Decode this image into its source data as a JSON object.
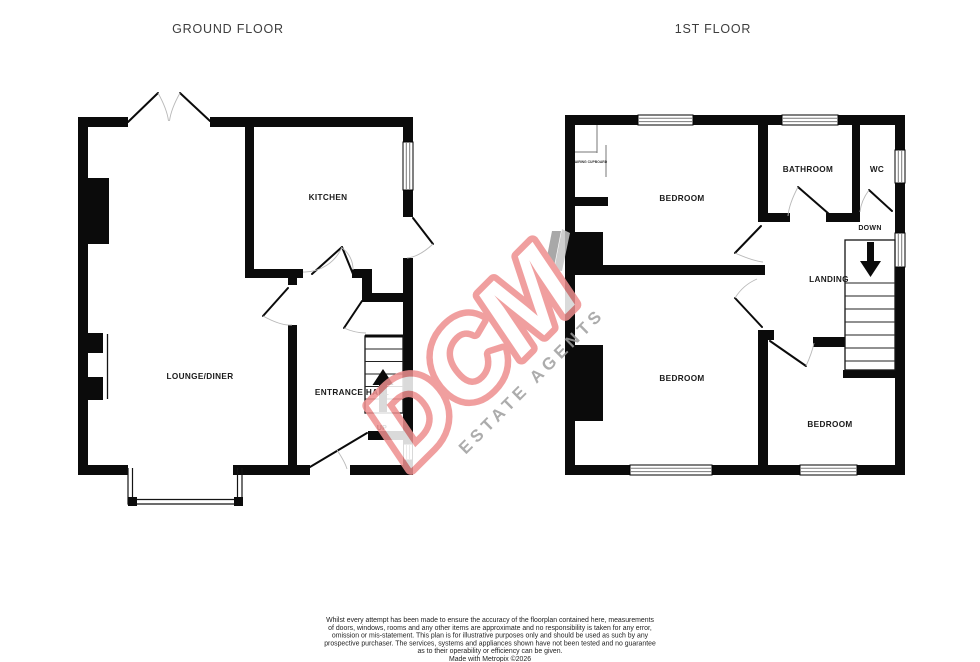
{
  "ground_floor": {
    "title": "GROUND FLOOR",
    "rooms": {
      "kitchen": "KITCHEN",
      "lounge_diner": "LOUNGE/DINER",
      "entrance_hall": "ENTRANCE HALL"
    },
    "stair_direction": "UP"
  },
  "first_floor": {
    "title": "1ST FLOOR",
    "rooms": {
      "bedroom_front": "BEDROOM",
      "bathroom": "BATHROOM",
      "wc": "WC",
      "landing": "LANDING",
      "bedroom_middle": "BEDROOM",
      "bedroom_back": "BEDROOM",
      "airing_cupboard": "AIRING CUPBOARD"
    },
    "stair_direction": "DOWN"
  },
  "watermark": {
    "brand": "DCM",
    "tagline": "ESTATE AGENTS",
    "brand_color": "#ee8f8f",
    "tagline_color": "#9e9e9e"
  },
  "disclaimer": {
    "lines": [
      "Whilst every attempt has been made to ensure the accuracy of the floorplan contained here, measurements",
      "of doors, windows, rooms and any other items are approximate and no responsibility is taken for any error,",
      "omission or mis-statement. This plan is for illustrative purposes only and should be used as such by any",
      "prospective purchaser. The services, systems and appliances shown have not been tested and no guarantee",
      "as to their operability or efficiency can be given.",
      "Made with Metropix ©2026"
    ]
  }
}
